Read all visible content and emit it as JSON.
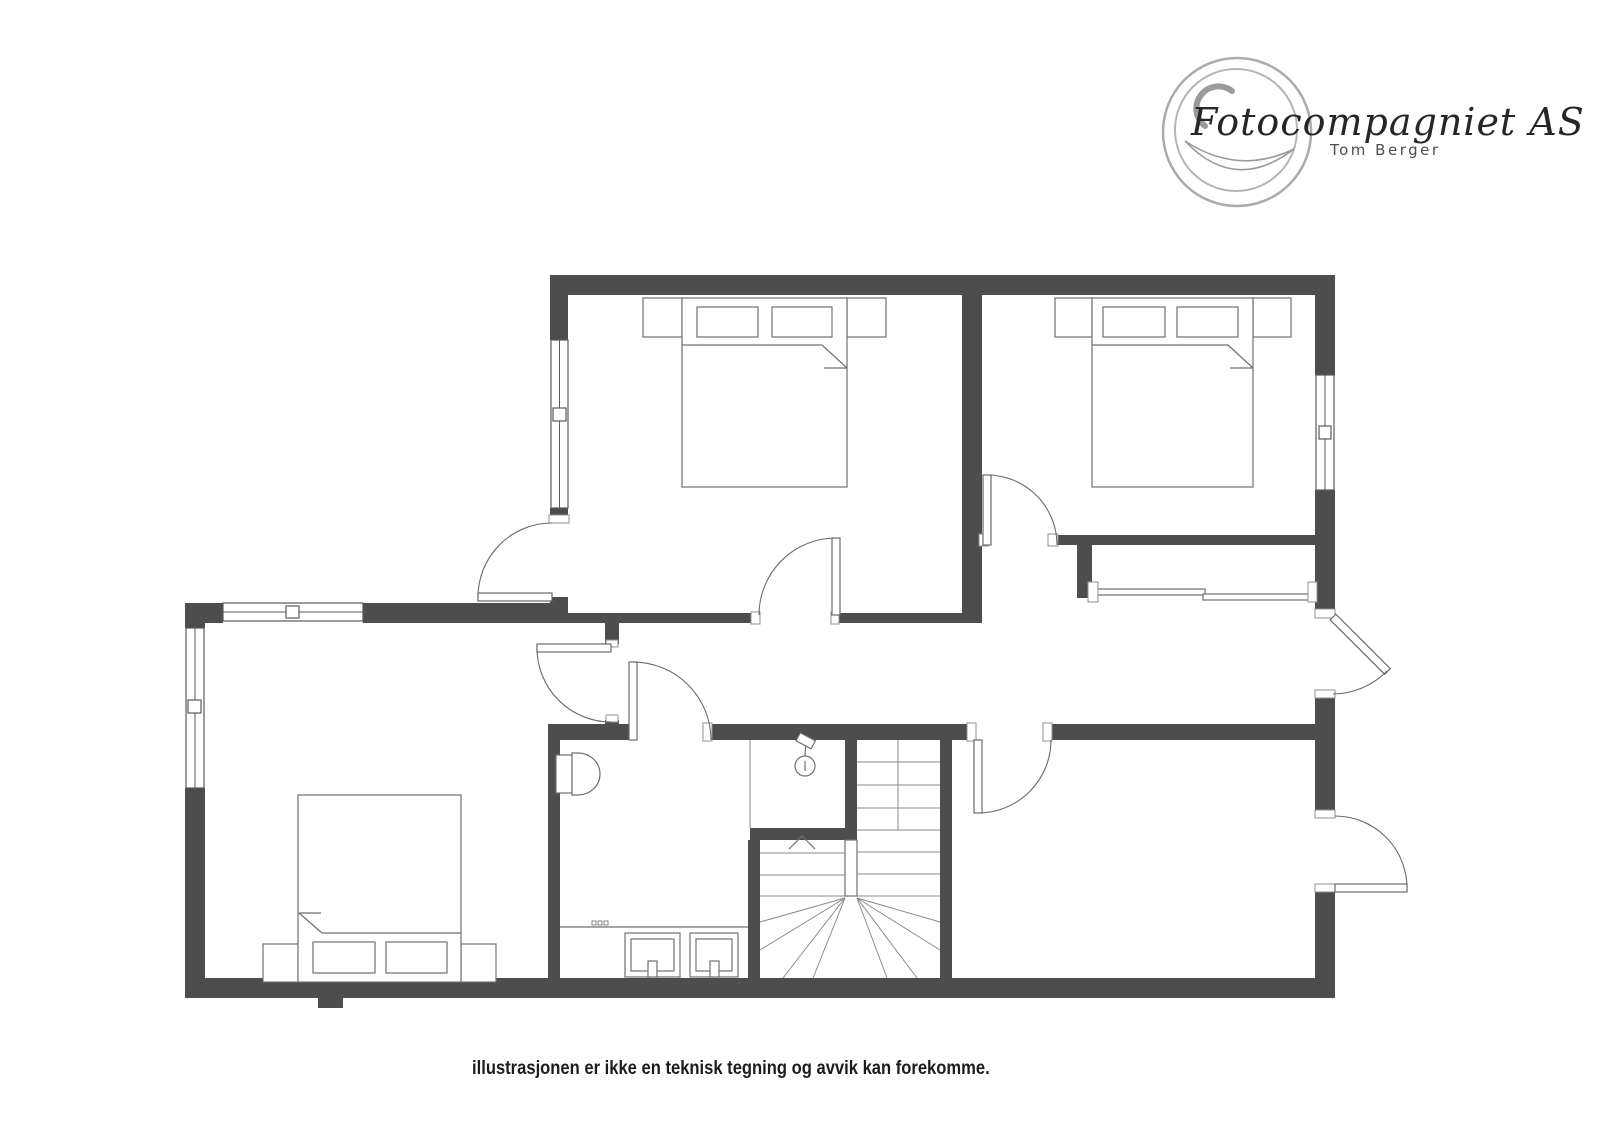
{
  "branding": {
    "company": "Fotocompagniet AS",
    "person": "Tom Berger"
  },
  "caption": {
    "text": "illustrasjonen er ikke en teknisk tegning og avvik kan forekomme."
  },
  "colors": {
    "wall": "#4d4d4d",
    "furniture_line": "#707070",
    "logo_ring": "#ababab",
    "caption_text": "#1c1c1c"
  },
  "floorplan": {
    "kind": "residential upper-floor plan illustration",
    "window_count": 4,
    "interior_door_count": 5,
    "exterior_door_count": 3,
    "icons": [
      "double-bed-icon",
      "double-bed-icon",
      "double-bed-icon",
      "nightstand-icon",
      "pillow-icon",
      "toilet-icon",
      "double-sink-vanity-icon",
      "shower-icon",
      "winder-staircase-icon",
      "stair-direction-arrow-icon",
      "wardrobe-rail-icon",
      "camera-lens-logo-icon"
    ]
  }
}
